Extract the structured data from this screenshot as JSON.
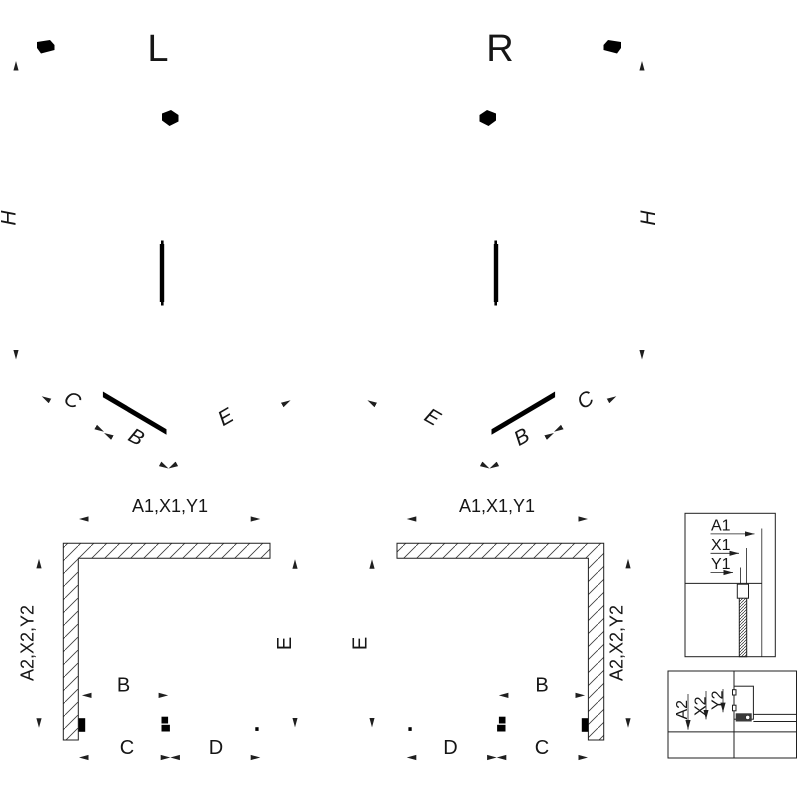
{
  "iso_left": {
    "variant": "L",
    "height_label": "H",
    "seg1": "C",
    "seg2": "B",
    "seg3": "E"
  },
  "iso_right": {
    "variant": "R",
    "height_label": "H",
    "seg1": "E",
    "seg2": "B",
    "seg3": "C"
  },
  "plan_left": {
    "top_dim": "A1,X1,Y1",
    "left_dim": "A2,X2,Y2",
    "right_dim": "E",
    "door_dim": "B",
    "bottom_dim1": "C",
    "bottom_dim2": "D"
  },
  "plan_right": {
    "top_dim": "A1,X1,Y1",
    "left_dim": "E",
    "right_dim": "A2,X2,Y2",
    "door_dim": "B",
    "bottom_dim1": "D",
    "bottom_dim2": "C"
  },
  "detail_top": {
    "dim1": "A1",
    "dim2": "X1",
    "dim3": "Y1"
  },
  "detail_bottom": {
    "dim1": "A2",
    "dim2": "X2",
    "dim3": "Y2"
  },
  "colors": {
    "line": "#1f1f1f",
    "background": "#ffffff",
    "seal_fill": "#3a3a3a"
  }
}
